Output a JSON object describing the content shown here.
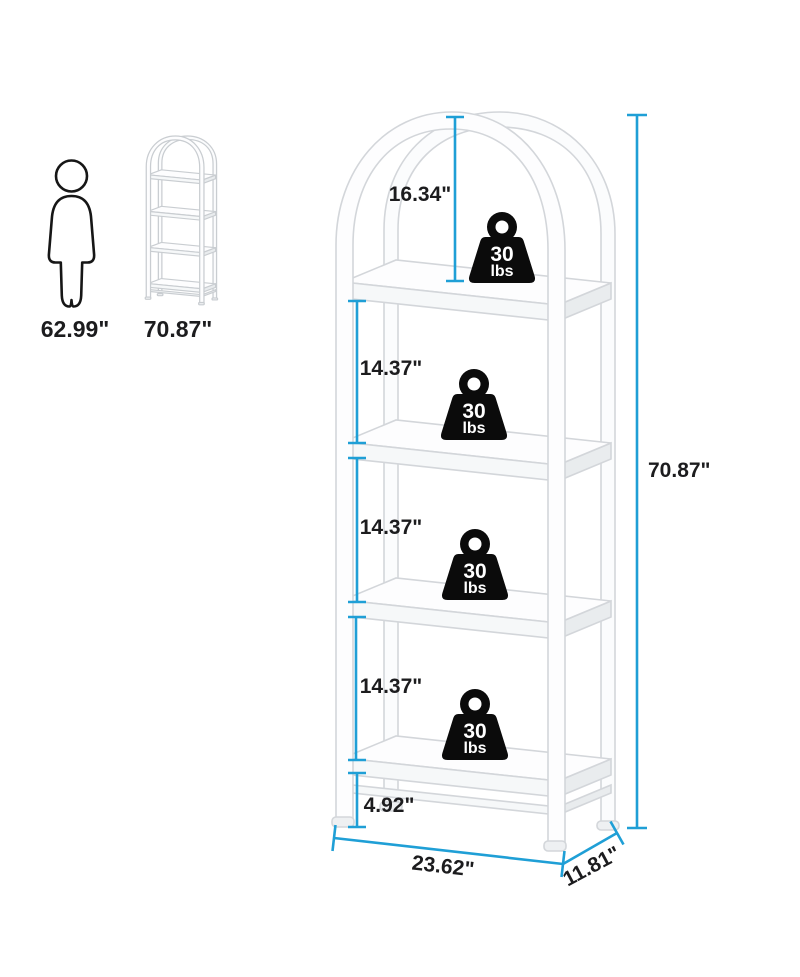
{
  "scale_reference": {
    "person_height_label": "62.99\"",
    "product_height_label": "70.87\""
  },
  "dimensions": {
    "arch_to_top_shelf": "16.34\"",
    "shelf_spacing_upper": "14.37\"",
    "shelf_spacing_middle": "14.37\"",
    "shelf_spacing_lower": "14.37\"",
    "bottom_clearance": "4.92\"",
    "overall_height": "70.87\"",
    "overall_width": "23.62\"",
    "overall_depth": "11.81\""
  },
  "shelf_capacity": {
    "value": "30",
    "unit": "lbs"
  },
  "colors": {
    "dimension_line": "#1f9fd6",
    "label_text": "#1c1c1e",
    "weight_fill": "#0b0b0b"
  }
}
